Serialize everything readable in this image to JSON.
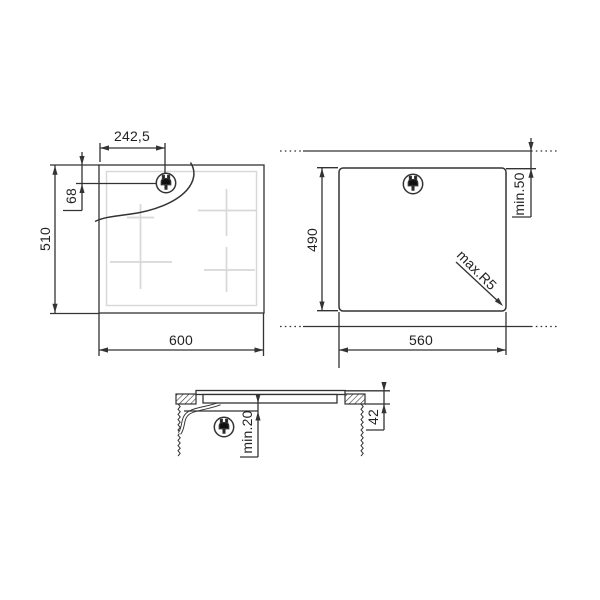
{
  "diagram": {
    "top_view": {
      "overall_width": "600",
      "overall_depth": "510",
      "plug_offset_from_left": "242,5",
      "plug_offset_from_top": "68"
    },
    "cutout_view": {
      "cutout_width": "560",
      "cutout_depth": "490",
      "rear_clearance": "min.50",
      "corner_radius": "max.R5"
    },
    "section_view": {
      "underside_clearance": "min.20",
      "built_in_depth": "42"
    },
    "icons": {
      "plug": "power-plug-icon"
    },
    "colors": {
      "line": "#333333",
      "zone_marker": "#d7d7d7",
      "text": "#222222",
      "background": "#ffffff"
    }
  }
}
